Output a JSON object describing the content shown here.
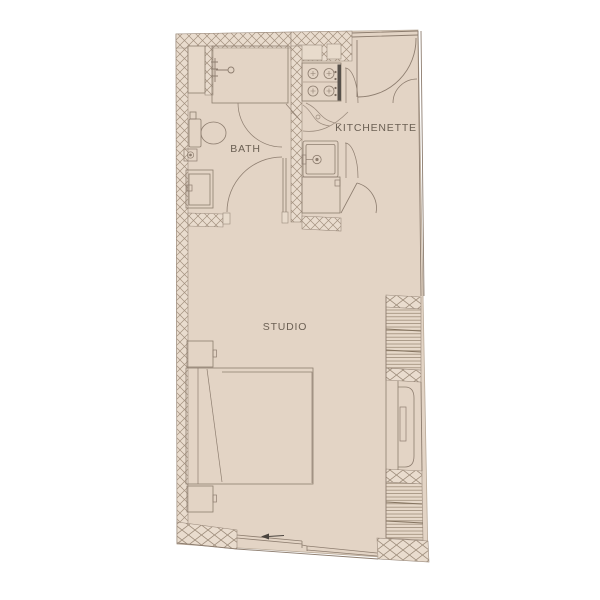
{
  "title": "Studio apartment floor plan",
  "palette": {
    "background": "#ffffff",
    "floor": "#e3d4c5",
    "wall_fill": "#e9dcce",
    "hatch_line": "#a3917f",
    "line": "#8d7d6f",
    "dark_detail": "#56504a",
    "text": "#6b6054"
  },
  "rooms": {
    "bath": {
      "label": "BATH"
    },
    "kitchenette": {
      "label": "KITCHENETTE"
    },
    "studio": {
      "label": "STUDIO"
    }
  },
  "fixtures": [
    "wall-shaft",
    "shower-tray",
    "shower-head",
    "shower-door",
    "toilet",
    "floor-drain",
    "vanity-sink",
    "bath-door",
    "cooktop-4-burner",
    "oven-handle",
    "kitchen-sink",
    "base-cabinet",
    "cabinet-door-upper",
    "cabinet-door-lower",
    "corridor-door",
    "entry-door",
    "closet-door",
    "bed",
    "nightstand-upper",
    "nightstand-lower",
    "radiator-panel",
    "louver-vent-upper",
    "louver-vent-lower",
    "picture-window",
    "direction-arrow"
  ]
}
